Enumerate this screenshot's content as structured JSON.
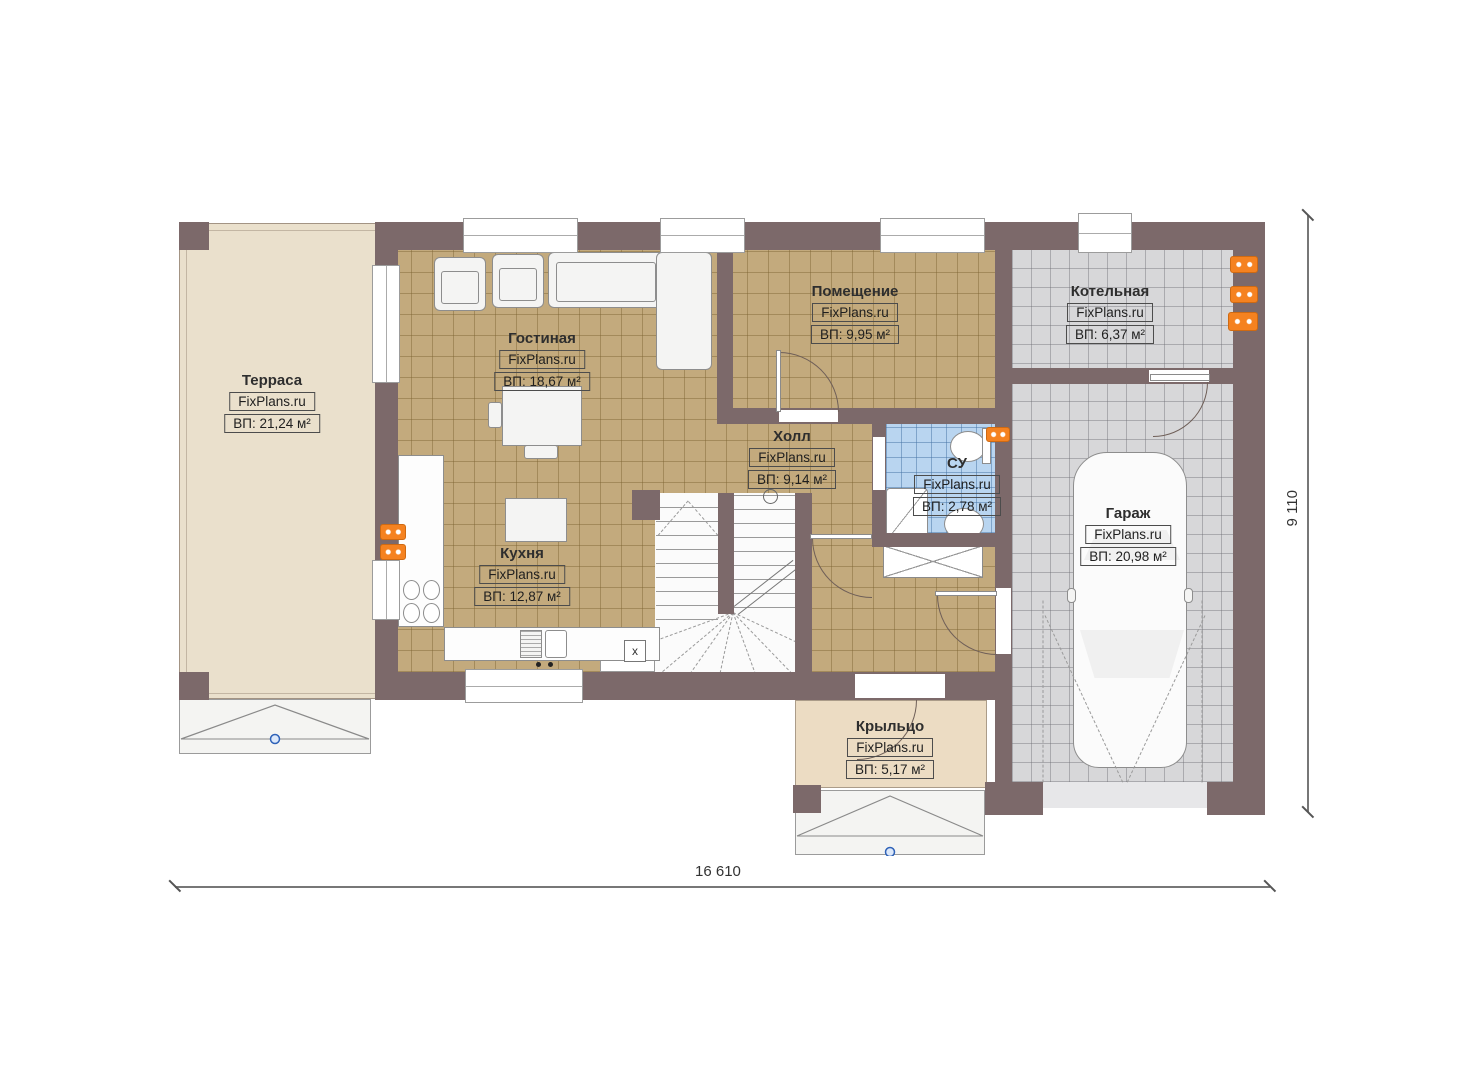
{
  "plan": {
    "site_watermark": "FixPlans.ru",
    "rooms": {
      "terrace": {
        "name": "Терраса",
        "watermark": "FixPlans.ru",
        "area": "ВП: 21,24 м²"
      },
      "living_room": {
        "name": "Гостиная",
        "watermark": "FixPlans.ru",
        "area": "ВП: 18,67 м²"
      },
      "utility_room": {
        "name": "Помещение",
        "watermark": "FixPlans.ru",
        "area": "ВП: 9,95 м²"
      },
      "boiler_room": {
        "name": "Котельная",
        "watermark": "FixPlans.ru",
        "area": "ВП: 6,37 м²"
      },
      "hall": {
        "name": "Холл",
        "watermark": "FixPlans.ru",
        "area": "ВП: 9,14 м²"
      },
      "bathroom": {
        "name": "СУ",
        "watermark": "FixPlans.ru",
        "area": "ВП: 2,78 м²"
      },
      "kitchen": {
        "name": "Кухня",
        "watermark": "FixPlans.ru",
        "area": "ВП: 12,87 м²"
      },
      "garage": {
        "name": "Гараж",
        "watermark": "FixPlans.ru",
        "area": "ВП: 20,98 м²"
      },
      "porch": {
        "name": "Крыльцо",
        "watermark": "FixPlans.ru",
        "area": "ВП: 5,17 м²"
      }
    },
    "dimensions": {
      "overall_width_mm": "16 610",
      "overall_height_mm": "9 110"
    },
    "annotations": {
      "under_stair_marker": "x"
    },
    "colors": {
      "wall": "#7c696a",
      "floor_wood": "#c3aa7d",
      "floor_tile_gray": "#d7d7d9",
      "floor_tile_blue": "#b9d5f0",
      "terrace_floor": "#eae0cc",
      "porch_floor": "#ecdcc3",
      "radiator_orange": "#f58220",
      "dimension_text": "#333333",
      "step_marker_blue": "#2f62b8"
    }
  }
}
